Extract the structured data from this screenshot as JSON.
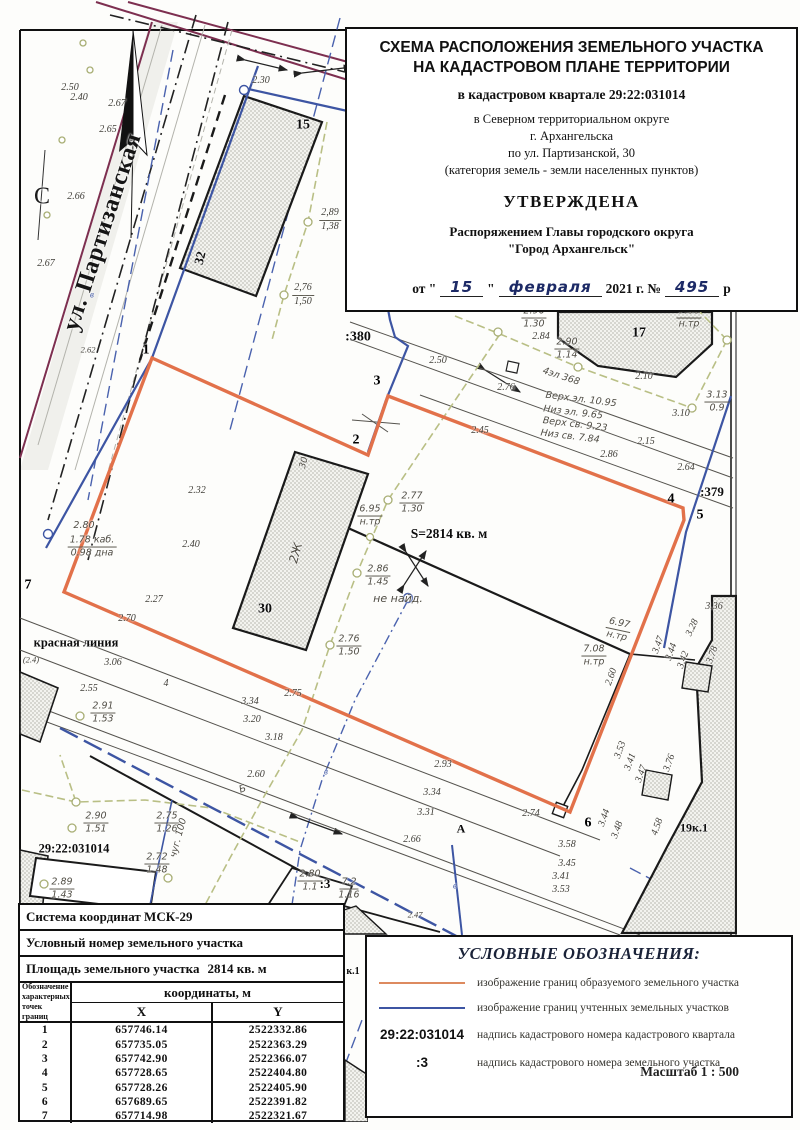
{
  "colors": {
    "parcel_new": "#e2714a",
    "parcel_existing": "#3d55a3",
    "street_line": "#7d2f50",
    "utility_line": "#b9bf85"
  },
  "tb": {
    "line1a": "СХЕМА РАСПОЛОЖЕНИЯ ЗЕМЕЛЬНОГО УЧАСТКА",
    "line1b": "НА КАДАСТРОВОМ ПЛАНЕ ТЕРРИТОРИИ",
    "kvartal": "в кадастровом квартале 29:22:031014",
    "addr1": "в Северном территориальном округе",
    "addr2": "г. Архангельска",
    "addr3": "по ул. Партизанской, 30",
    "addr4": "(категория земель - земли населенных пунктов)",
    "approved": "УТВЕРЖДЕНА",
    "order1": "Распоряжением Главы городского округа",
    "order2": "\"Город Архангельск\"",
    "d_ot": "от \"",
    "d_day": "15",
    "d_close": "\"",
    "d_month": "февраля",
    "d_year": "2021 г. №",
    "d_num": "495",
    "d_r": "р"
  },
  "table": {
    "r1": "Система координат МСК-29",
    "r2": "Условный номер земельного участка",
    "r3_label": "Площадь земельного участка",
    "r3_value": "2814 кв. м",
    "col1": "Обозначение\nхарактерных\nточек границ",
    "coords_header": "координаты, м",
    "colX": "X",
    "colY": "Y",
    "rows": [
      [
        "1",
        "657746.14",
        "2522332.86"
      ],
      [
        "2",
        "657735.05",
        "2522363.29"
      ],
      [
        "3",
        "657742.90",
        "2522366.07"
      ],
      [
        "4",
        "657728.65",
        "2522404.80"
      ],
      [
        "5",
        "657728.26",
        "2522405.90"
      ],
      [
        "6",
        "657689.65",
        "2522391.82"
      ],
      [
        "7",
        "657714.98",
        "2522321.67"
      ]
    ]
  },
  "legend": {
    "title": "УСЛОВНЫЕ ОБОЗНАЧЕНИЯ:",
    "items": [
      {
        "symbol": "",
        "text": "изображение границ образуемого земельного участка"
      },
      {
        "symbol": "",
        "text": "изображение границ учтенных земельных участков"
      },
      {
        "symbol": "29:22:031014",
        "text": "надпись кадастрового номера кадастрового квартала"
      },
      {
        "symbol": ":3",
        "text": "надпись кадастрового номера земельного участка"
      }
    ],
    "scale": "Масштаб  1 : 500"
  },
  "map": {
    "labels": [
      {
        "t": "ул. Партизанская",
        "x": 103,
        "y": 232,
        "cls": "street",
        "r": -72,
        "name": "street-label"
      },
      {
        "t": "С",
        "x": 42,
        "y": 197,
        "cls": "north",
        "name": "north-arrow-letter"
      },
      {
        "t": "2.50",
        "x": 70,
        "y": 88
      },
      {
        "t": "2.40",
        "x": 79,
        "y": 98
      },
      {
        "t": "2.67",
        "x": 117,
        "y": 104
      },
      {
        "t": "2.65",
        "x": 108,
        "y": 130
      },
      {
        "t": "2.66",
        "x": 76,
        "y": 197
      },
      {
        "t": "2.67",
        "x": 46,
        "y": 264
      },
      {
        "t": "2.62",
        "x": 88,
        "y": 350,
        "cls": "small"
      },
      {
        "t": "2.30",
        "x": 261,
        "y": 81
      },
      {
        "t": "15",
        "x": 303,
        "y": 126,
        "cls": "bold",
        "s": 14
      },
      {
        "t": "32",
        "x": 200,
        "y": 258,
        "cls": "bold",
        "r": -75
      },
      {
        "t": ":380",
        "x": 358,
        "y": 338,
        "cls": "bold",
        "s": 14,
        "name": "parcel-number-label"
      },
      {
        "t": "1",
        "x": 146,
        "y": 351,
        "cls": "pt",
        "name": "point-label"
      },
      {
        "t": "2",
        "x": 356,
        "y": 441,
        "cls": "pt",
        "name": "point-label"
      },
      {
        "t": "3",
        "x": 377,
        "y": 382,
        "cls": "pt",
        "name": "point-label"
      },
      {
        "t": "4",
        "x": 671,
        "y": 500,
        "cls": "pt",
        "name": "point-label"
      },
      {
        "t": "5",
        "x": 700,
        "y": 516,
        "cls": "pt",
        "name": "point-label"
      },
      {
        "t": "6",
        "x": 588,
        "y": 824,
        "cls": "pt",
        "name": "point-label"
      },
      {
        "t": "7",
        "x": 28,
        "y": 586,
        "cls": "pt",
        "name": "point-label"
      },
      {
        "t": "30",
        "x": 265,
        "y": 610,
        "cls": "bold",
        "s": 14
      },
      {
        "t": "30",
        "x": 305,
        "y": 463,
        "cls": "hand",
        "r": -75,
        "s": 9
      },
      {
        "t": "2Ж",
        "x": 296,
        "y": 553,
        "cls": "hand",
        "r": -75,
        "s": 12
      },
      {
        "t": "17",
        "x": 639,
        "y": 334,
        "cls": "bold",
        "s": 14
      },
      {
        "t": "19к.1",
        "x": 694,
        "y": 828,
        "cls": "bold",
        "s": 12
      },
      {
        "t": "к.1",
        "x": 353,
        "y": 972,
        "cls": "bold",
        "s": 10
      },
      {
        "t": ":379",
        "x": 712,
        "y": 492,
        "cls": "bold",
        "name": "parcel-number-label"
      },
      {
        "t": ":3",
        "x": 325,
        "y": 884,
        "cls": "bold",
        "name": "parcel-number-label"
      },
      {
        "t": "29:22:031014",
        "x": 74,
        "y": 849,
        "cls": "bold",
        "s": 12.5,
        "name": "quarter-label"
      },
      {
        "t": "красная линия",
        "x": 76,
        "y": 643,
        "cls": "bold",
        "s": 12.5,
        "name": "red-line-label"
      },
      {
        "t": "S=2814 кв. м",
        "x": 449,
        "y": 534,
        "cls": "bold",
        "s": 13.5,
        "name": "area-label"
      },
      {
        "t": "2,89/1,38",
        "x": 330,
        "y": 220,
        "cls": "frac"
      },
      {
        "t": "2,76/1,50",
        "x": 303,
        "y": 295,
        "cls": "frac"
      },
      {
        "t": "2.96/1.30",
        "x": 534,
        "y": 318,
        "cls": "frac hand"
      },
      {
        "t": "2.90/1.14",
        "x": 567,
        "y": 349,
        "cls": "frac hand"
      },
      {
        "t": "2.77/1.30",
        "x": 412,
        "y": 503,
        "cls": "frac hand"
      },
      {
        "t": "6.95/н.тр",
        "x": 370,
        "y": 516,
        "cls": "frac hand"
      },
      {
        "t": "2.86/1.45",
        "x": 378,
        "y": 576,
        "cls": "frac hand"
      },
      {
        "t": "2.76/1.50",
        "x": 349,
        "y": 646,
        "cls": "frac hand"
      },
      {
        "t": "7.66/н.тр",
        "x": 689,
        "y": 318,
        "cls": "frac hand"
      },
      {
        "t": "3.13/0.9",
        "x": 717,
        "y": 402,
        "cls": "frac hand"
      },
      {
        "t": "6.97/н.тр",
        "x": 618,
        "y": 630,
        "cls": "frac hand",
        "r": 12
      },
      {
        "t": "7.08/н.тр",
        "x": 594,
        "y": 656,
        "cls": "frac hand"
      },
      {
        "t": "2.90/1.51",
        "x": 96,
        "y": 823,
        "cls": "frac hand"
      },
      {
        "t": "2.75/1.26",
        "x": 167,
        "y": 823,
        "cls": "frac hand"
      },
      {
        "t": "2.72/1.48",
        "x": 157,
        "y": 864,
        "cls": "frac hand"
      },
      {
        "t": "2.89/1.43",
        "x": 62,
        "y": 889,
        "cls": "frac hand"
      },
      {
        "t": "2.91/1.53",
        "x": 103,
        "y": 713,
        "cls": "frac hand"
      },
      {
        "t": "2.80/1.1",
        "x": 310,
        "y": 881,
        "cls": "frac hand"
      },
      {
        "t": "7.2/1.16",
        "x": 349,
        "y": 889,
        "cls": "frac hand"
      },
      {
        "t": "2.80",
        "x": 84,
        "y": 526,
        "cls": "hand"
      },
      {
        "t": "1.78 каб./0.98 дна",
        "x": 92,
        "y": 547,
        "cls": "frac hand"
      },
      {
        "t": "не найд.",
        "x": 398,
        "y": 599,
        "cls": "hand",
        "s": 11
      },
      {
        "t": "чуг. 100",
        "x": 179,
        "y": 838,
        "cls": "hand",
        "r": -75
      },
      {
        "t": "4эл 368",
        "x": 561,
        "y": 377,
        "cls": "hand",
        "r": 18
      },
      {
        "t": "Верх эл. 10.95",
        "x": 581,
        "y": 400,
        "cls": "hand",
        "r": 7
      },
      {
        "t": "Низ эл. 9.65",
        "x": 573,
        "y": 413,
        "cls": "hand",
        "r": 7
      },
      {
        "t": "Верх св. 9.23",
        "x": 575,
        "y": 425,
        "cls": "hand",
        "r": 7
      },
      {
        "t": "Низ св. 7.84",
        "x": 570,
        "y": 437,
        "cls": "hand",
        "r": 7
      },
      {
        "t": "2.50",
        "x": 438,
        "y": 361
      },
      {
        "t": "2.76",
        "x": 506,
        "y": 388
      },
      {
        "t": "2.84",
        "x": 541,
        "y": 337
      },
      {
        "t": "2.10",
        "x": 644,
        "y": 377
      },
      {
        "t": "3.10",
        "x": 681,
        "y": 414
      },
      {
        "t": "2.15",
        "x": 646,
        "y": 442
      },
      {
        "t": "2.64",
        "x": 686,
        "y": 468
      },
      {
        "t": "2.45",
        "x": 480,
        "y": 431
      },
      {
        "t": "2.86",
        "x": 609,
        "y": 455
      },
      {
        "t": "2.32",
        "x": 197,
        "y": 491
      },
      {
        "t": "2.40",
        "x": 191,
        "y": 545
      },
      {
        "t": "2.27",
        "x": 154,
        "y": 600
      },
      {
        "t": "2.70",
        "x": 127,
        "y": 619
      },
      {
        "t": "3.06",
        "x": 113,
        "y": 663
      },
      {
        "t": "(2.4)",
        "x": 31,
        "y": 660,
        "cls": "small"
      },
      {
        "t": "2.55",
        "x": 89,
        "y": 689
      },
      {
        "t": "4",
        "x": 166,
        "y": 684
      },
      {
        "t": "2.75",
        "x": 293,
        "y": 694
      },
      {
        "t": "3.34",
        "x": 250,
        "y": 702
      },
      {
        "t": "3.20",
        "x": 252,
        "y": 720
      },
      {
        "t": "3.18",
        "x": 274,
        "y": 738
      },
      {
        "t": "2.60",
        "x": 256,
        "y": 775
      },
      {
        "t": "2.93",
        "x": 443,
        "y": 765
      },
      {
        "t": "3.34",
        "x": 432,
        "y": 793
      },
      {
        "t": "3.31",
        "x": 426,
        "y": 813
      },
      {
        "t": "2.66",
        "x": 412,
        "y": 840
      },
      {
        "t": "А",
        "x": 461,
        "y": 829,
        "cls": "bold",
        "s": 12
      },
      {
        "t": "Б",
        "x": 243,
        "y": 790,
        "cls": "hand",
        "r": -20,
        "s": 10
      },
      {
        "t": "2.74",
        "x": 531,
        "y": 814
      },
      {
        "t": "3.58",
        "x": 567,
        "y": 845
      },
      {
        "t": "3.45",
        "x": 567,
        "y": 864
      },
      {
        "t": "3.41",
        "x": 561,
        "y": 877
      },
      {
        "t": "3.53",
        "x": 561,
        "y": 890
      },
      {
        "t": "3.44",
        "x": 605,
        "y": 818,
        "r": -70
      },
      {
        "t": "3.48",
        "x": 618,
        "y": 830,
        "r": -70
      },
      {
        "t": "4.58",
        "x": 658,
        "y": 827,
        "r": -70
      },
      {
        "t": "2.60",
        "x": 612,
        "y": 677,
        "r": -70
      },
      {
        "t": "3.36",
        "x": 714,
        "y": 607
      },
      {
        "t": "3.28",
        "x": 693,
        "y": 628,
        "r": -65
      },
      {
        "t": "3.47",
        "x": 659,
        "y": 645,
        "r": -70
      },
      {
        "t": "3.44",
        "x": 672,
        "y": 652,
        "r": -70
      },
      {
        "t": "3.42",
        "x": 684,
        "y": 660,
        "r": -70
      },
      {
        "t": "3.78",
        "x": 713,
        "y": 655,
        "r": -70
      },
      {
        "t": "3.53",
        "x": 621,
        "y": 750,
        "r": -70
      },
      {
        "t": "3.41",
        "x": 631,
        "y": 762,
        "r": -70
      },
      {
        "t": "3.47",
        "x": 642,
        "y": 774,
        "r": -70
      },
      {
        "t": "3.76",
        "x": 670,
        "y": 763,
        "r": -70
      },
      {
        "t": "2.47",
        "x": 415,
        "y": 915,
        "cls": "small"
      },
      {
        "t": "в",
        "x": 92,
        "y": 295,
        "cls": "blue small"
      },
      {
        "t": "в",
        "x": 326,
        "y": 772,
        "cls": "blue small"
      },
      {
        "t": "в",
        "x": 455,
        "y": 886,
        "cls": "blue small"
      }
    ]
  }
}
